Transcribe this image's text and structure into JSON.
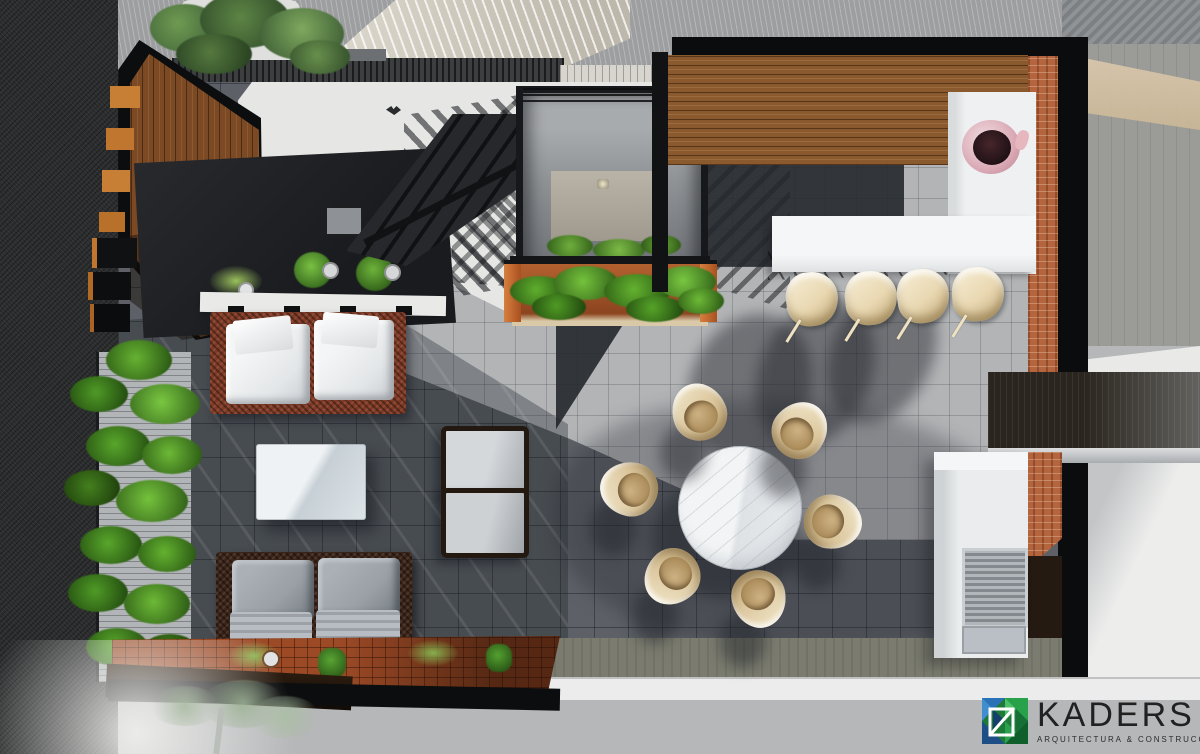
{
  "scene": {
    "title": "Top-down 3D architectural render of a rooftop terrace with lounge, dining and grill areas",
    "view": "top-down plan render"
  },
  "logo": {
    "brand": "KADERS",
    "tagline": "ARQUITECTURA & CONSTRUCCIÓN"
  },
  "palette": {
    "sidewalk": "#b6b7b9",
    "asphalt": "#2c2d2e",
    "tile_light": "#b2b4b6",
    "tile_mid": "#5d6167",
    "floor_white": "#e6e6e4",
    "charcoal": "#1f2124",
    "wood_wall": "#7b4a24",
    "pergola_wood": "#8a5a2e",
    "brick": "#b4653e",
    "counter": "#eef0f1",
    "stool": "#e9d8b2",
    "chair_tan": "#dcc79e",
    "marble": "#f2f4f5",
    "sofa1_frame": "#7e3a26",
    "sofa2_frame": "#39241a",
    "cushion_white": "#e3e6e8",
    "cushion_gray": "#9aa0a6",
    "green": "#4e8f28",
    "terracotta": "#9c4a26",
    "clay": "#b3602f",
    "olive": "#7b7c6f",
    "gate": "#2a251e",
    "ink": "#212121",
    "logo_blue": "#2a72b8",
    "logo_green": "#27a24a"
  },
  "inventory": {
    "dining_chairs": 6,
    "bar_stools": 4,
    "sofas": 2,
    "lounge_chairs": 2,
    "dining_tables": 1,
    "coffee_tables": 1,
    "bar_counters": 1,
    "grill_stations": 1,
    "planters": 3,
    "staircases": 1
  }
}
